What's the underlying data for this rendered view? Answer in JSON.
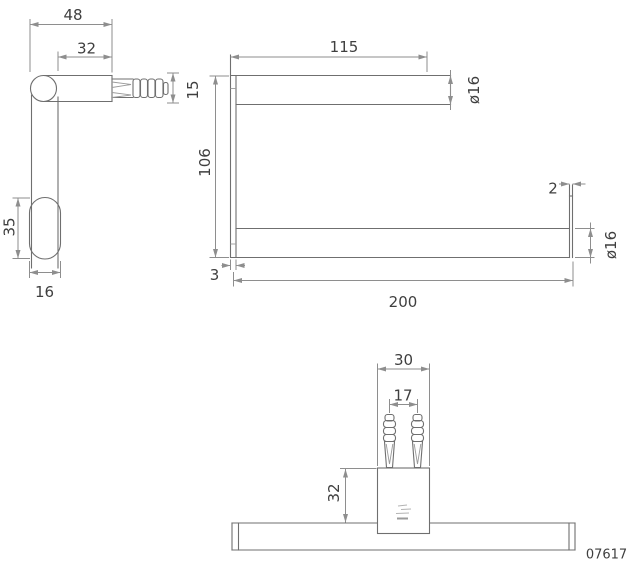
{
  "part_number": "07617",
  "icons": {
    "brand_mark": "brand-logo-mark"
  },
  "colors": {
    "background": "#ffffff",
    "object_line": "#6f6f6f",
    "dimension_line": "#8e8e8e",
    "text": "#3f3f3f"
  },
  "side_view": {
    "total_depth": "48",
    "arm_depth": "32",
    "arm_height": "15",
    "endplate_height": "35",
    "endplate_depth": "16"
  },
  "front_view": {
    "top_bar_length": "115",
    "top_bar_diameter": "ø16",
    "overall_height": "106",
    "post_thickness": "3",
    "bottom_bar_length": "200",
    "end_stop_thickness": "2",
    "bottom_bar_diameter": "ø16"
  },
  "bottom_view": {
    "plate_width": "30",
    "dowel_spacing": "17",
    "wall_offset": "32"
  }
}
